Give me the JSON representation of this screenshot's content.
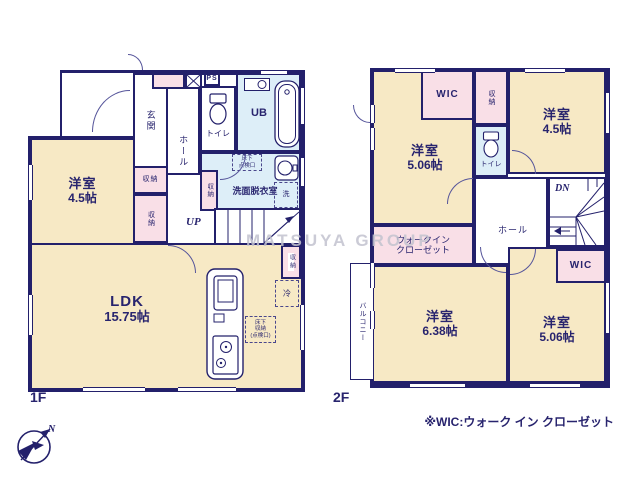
{
  "f1": {
    "floor_label": "1F",
    "yoshitsu": {
      "name": "洋室",
      "size": "4.5帖"
    },
    "ldk": {
      "name": "LDK",
      "size": "15.75帖"
    },
    "genkan": "玄関",
    "hall": "ホール",
    "toilet": "トイレ",
    "ub": "UB",
    "ps": "PS",
    "senmen": "洗面脱衣室",
    "sen": "洗",
    "rei": "冷",
    "shuno": "収納",
    "up": "UP",
    "tenken": {
      "l1": "床下",
      "l2": "点検口"
    },
    "yukashita": {
      "l1": "床下",
      "l2": "収納",
      "l3": "(点検口)"
    }
  },
  "f2": {
    "floor_label": "2F",
    "yoshitsu_nw": {
      "name": "洋室",
      "size": "5.06帖"
    },
    "yoshitsu_ne": {
      "name": "洋室",
      "size": "4.5帖"
    },
    "yoshitsu_sw": {
      "name": "洋室",
      "size": "6.38帖"
    },
    "yoshitsu_se": {
      "name": "洋室",
      "size": "5.06帖"
    },
    "wic": "WIC",
    "shuno": "収納",
    "toilet": "トイレ",
    "hall": "ホール",
    "dn": "DN",
    "walkin": {
      "l1": "ウォークイン",
      "l2": "クローゼット"
    },
    "balcony": "バルコニー"
  },
  "annotations": {
    "footnote": "※WIC:ウォーク イン クローゼット",
    "watermark": "MATSUYA GROUP",
    "compass_north": "N"
  },
  "colors": {
    "wall": "#23206b",
    "room_cream": "#f7e9c5",
    "closet_pink": "#f9dfe7",
    "wet_blue": "#ddeef8",
    "text": "#28246e",
    "watermark_gray": "#c3c3cf"
  }
}
